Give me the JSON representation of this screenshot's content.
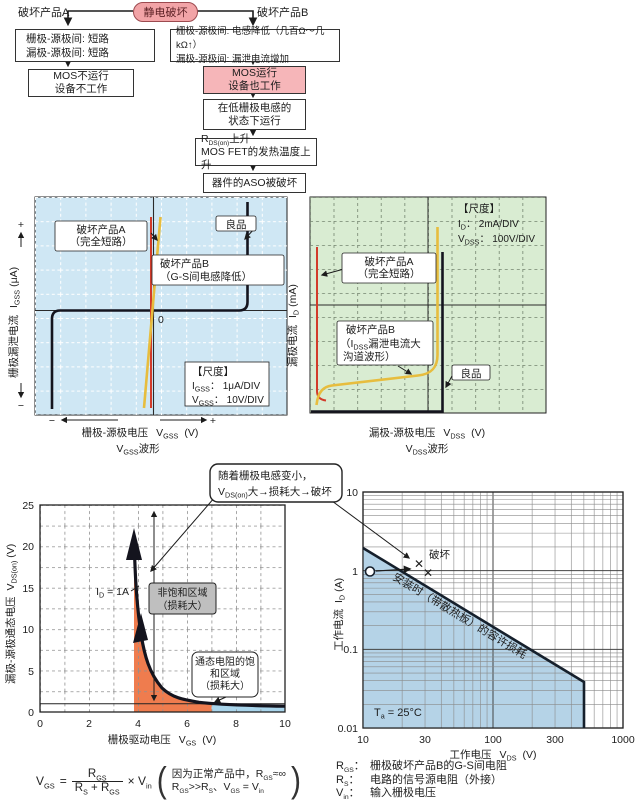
{
  "colors": {
    "pink_fill": "#f6b6b9",
    "pill_fill": "#f2a4a7",
    "pill_border": "#9c4a4f",
    "blue_bg": "#cfe7f4",
    "green_bg": "#d9ecd2",
    "red_line": "#d23b2a",
    "yellow_line": "#e7bd3e",
    "curve_black": "#14141e",
    "orange_fill": "#ef7c4e",
    "lightblue_fill": "#a9d5ec",
    "soa_fill": "#b5d3e7",
    "gray_box": "#bfbfbf"
  },
  "sym": {
    "V": "V",
    "I": "I",
    "R": "R",
    "T": "T",
    "GS": "GS",
    "GSS": "GSS",
    "DS": "DS",
    "DSS": "DSS",
    "D": "D",
    "S": "S",
    "DSon": "DS(on)",
    "in": "in",
    "a": "a"
  },
  "flow": {
    "a_label": "破坏产品A",
    "b_label": "破坏产品B",
    "root": "静电破坏",
    "a1l1": "栅极-源极间: 短路",
    "a1l2": "漏极-源极间: 短路",
    "a2l1": "MOS不运行",
    "a2l2": "设备不工作",
    "b1l1": "栅极-源极间: 电感降低（几百Ω～几kΩ↑）",
    "b1l2": "漏极-源极间: 漏泄电流增加",
    "b2l1": "MOS运行",
    "b2l2": "设备也工作",
    "b3l1": "在低栅极电感的",
    "b3l2": "状态下运行",
    "b4l1_suf": "上升",
    "b4l2": "MOS FET的发热温度上升",
    "b5": "器件的ASO被破坏"
  },
  "gss": {
    "prod_a1": "破坏产品A",
    "prod_a2": "（完全短路）",
    "good": "良品",
    "prod_b1": "破坏产品B",
    "prod_b2": "（G-S间电感降低）",
    "zero": "0",
    "scale_title": "【尺度】",
    "scale_i_suf": "： 1μA/DIV",
    "scale_v_suf": "： 10V/DIV",
    "ylabel": "栅极漏泄电流",
    "y_unit": "(μA)",
    "plus": "+",
    "minus": "−",
    "xlabel": "栅极-源极电压",
    "x_unit": "(V)",
    "wave": "波形"
  },
  "dss": {
    "scale_title": "【尺度】",
    "scale_i_suf": "： 2mA/DIV",
    "scale_v_suf": "： 100V/DIV",
    "prod_a1": "破坏产品A",
    "prod_a2": "（完全短路）",
    "prod_b1": "破坏产品B",
    "b_l2_open": "（",
    "b_l2_suf": "漏泄电流大",
    "b_l3": "沟道波形）",
    "good": "良品",
    "ylabel": "漏极电流",
    "y_unit": "(mA)",
    "xlabel": "漏极-源极电压",
    "x_unit": "(V)",
    "wave": "波形"
  },
  "callout": {
    "l1": "随着栅极电感变小，",
    "l2_suffix": "大→损耗大→破坏"
  },
  "vchart": {
    "y_ticks": [
      "25",
      "20",
      "15",
      "10",
      "5",
      "0"
    ],
    "x_ticks": [
      "0",
      "2",
      "4",
      "6",
      "8",
      "10"
    ],
    "ylabel": "漏极-源极通态电压",
    "y_unit": "(V)",
    "xlabel": "栅极驱动电压",
    "x_unit": "(V)",
    "id_suffix": " = 1A",
    "region1_l1": "非饱和区域",
    "region1_l2": "（损耗大）",
    "region2_l1": "通态电阻的饱",
    "region2_l2": "和区域",
    "region2_l3": "（损耗大）"
  },
  "pchart": {
    "y_ticks": [
      "10",
      "1",
      "0.1",
      "0.01"
    ],
    "x_ticks": [
      "10",
      "30",
      "100",
      "300",
      "1000"
    ],
    "ylabel": "工作电流",
    "y_unit": "(A)",
    "xlabel": "工作电压",
    "x_unit": "(V)",
    "fail": "破坏",
    "cross": "✕",
    "diag": "安装时（带散热板）的容许损耗",
    "ta_suffix": " = 25°C"
  },
  "formula": {
    "eq": "=",
    "times": "×",
    "frac_plus": " + ",
    "note1_pre": "因为正常产品中，",
    "note1_suf": "≈∞",
    "gg": ">>",
    "cma": "、",
    "eq2": " = ",
    "popen": "(",
    "pclose": ")"
  },
  "notes": {
    "colon": "：",
    "r1": "栅极破坏产品B的G-S间电阻",
    "r2": "电路的信号源电阻（外接）",
    "r3": "输入栅极电压"
  },
  "chart_data": [
    {
      "type": "line",
      "title": "栅极漏泄电流波形 (curve tracer)",
      "xlabel": "栅极-源极电压 VGSS (V)",
      "ylabel": "栅极漏泄电流 IGSS (μA)",
      "scale": {
        "IGSS": "1μA/DIV",
        "VGSS": "10V/DIV"
      },
      "series": [
        {
          "name": "良品",
          "shape": "flat at 0 with breakdown rises at both extremes"
        },
        {
          "name": "破坏产品A（完全短路）",
          "shape": "vertical line through 0"
        },
        {
          "name": "破坏产品B（G-S间电感降低）",
          "shape": "steep resistive line through 0"
        }
      ]
    },
    {
      "type": "line",
      "title": "漏极电流波形 (curve tracer)",
      "xlabel": "漏极-源极电压 VDSS (V)",
      "ylabel": "漏极电流 ID (mA)",
      "scale": {
        "ID": "2mA/DIV",
        "VDSS": "100V/DIV"
      },
      "series": [
        {
          "name": "良品",
          "shape": "zero current then vertical breakdown"
        },
        {
          "name": "破坏产品A（完全短路）",
          "shape": "vertical line at 0"
        },
        {
          "name": "破坏产品B（IDSS漏泄电流大 沟道波形）",
          "shape": "large leakage ramp then breakdown"
        }
      ]
    },
    {
      "type": "line",
      "title": "VGS vs VDS(on) (ID = 1A)",
      "xlabel": "栅极驱动电压 VGS (V)",
      "ylabel": "漏极-源极通态电压 VDS(on) (V)",
      "xlim": [
        0,
        10
      ],
      "ylim": [
        0,
        25
      ],
      "series": [
        {
          "name": "VDS(on)",
          "x": [
            3.85,
            3.95,
            4.1,
            4.3,
            4.6,
            5,
            5.5,
            6,
            6.5,
            7,
            8,
            9,
            10
          ],
          "y": [
            21,
            15,
            10,
            7,
            4.5,
            2.8,
            1.9,
            1.4,
            1.15,
            1,
            0.85,
            0.75,
            0.7
          ]
        }
      ],
      "annotations": [
        "ID = 1A",
        "非饱和区域（损耗大）",
        "通态电阻的饱和区域（损耗大）"
      ]
    },
    {
      "type": "line",
      "title": "容许损耗 (SOA)",
      "xlabel": "工作电压 VDS (V)",
      "ylabel": "工作电流 ID (A)",
      "xscale": "log",
      "yscale": "log",
      "xlim": [
        10,
        1000
      ],
      "ylim": [
        0.01,
        10
      ],
      "series": [
        {
          "name": "安装时（带散热板）的容许损耗",
          "x": [
            10,
            500,
            500
          ],
          "y": [
            2,
            0.04,
            0.01
          ]
        }
      ],
      "points": [
        {
          "label": "工作点",
          "x": 11,
          "y": 1
        },
        {
          "label": "破坏",
          "x": 28,
          "y": 1.3
        },
        {
          "label": "破坏",
          "x": 31,
          "y": 0.95
        }
      ],
      "annotations": [
        "Ta = 25°C"
      ]
    }
  ]
}
